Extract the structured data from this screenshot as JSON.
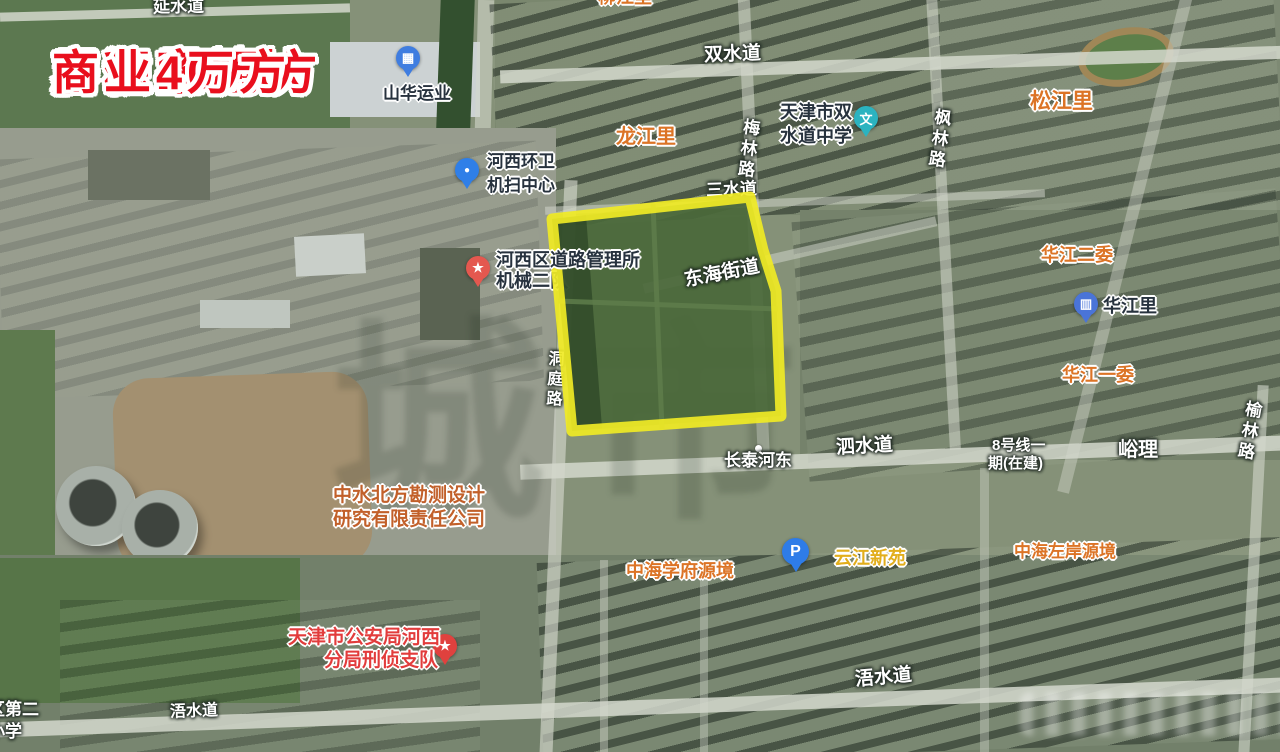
{
  "annotation": {
    "lines": [
      "富江里地块",
      "容积率2.0",
      "居住10万方",
      "商业4万方"
    ],
    "color": "#e90f1d"
  },
  "parcel": {
    "outline_color": "#f0ea25",
    "fill_color": "#4a683a"
  },
  "watermark": {
    "text": "城市"
  },
  "pois": {
    "shanhua": {
      "label": "山华运业",
      "glyph": "▦",
      "pin_color": "#3f7de0"
    },
    "huanwei": {
      "line1": "河西环卫",
      "line2": "机扫中心",
      "glyph": "●",
      "pin_color": "#2f7fe8"
    },
    "daolu": {
      "line1": "河西区道路管理所",
      "line2": "机械二队",
      "glyph": "★",
      "pin_color": "#e4584f"
    },
    "zhongxue": {
      "line1": "天津市双",
      "line2": "水道中学",
      "glyph": "文",
      "pin_color": "#2bb3c0"
    },
    "huajiangli": {
      "label": "华江里",
      "glyph": "▥",
      "pin_color": "#4a74d8"
    },
    "parking": {
      "glyph": "P",
      "pin_color": "#2e7ce8"
    },
    "gonganju": {
      "line1": "天津市公安局河西",
      "line2": "分局刑侦支队",
      "glyph": "★",
      "pin_color": "#e0413e"
    },
    "zhongshui": {
      "line1": "中水北方勘测设计",
      "line2": "研究有限责任公司"
    }
  },
  "areas": {
    "longjiangli": "龙江里",
    "songjiangli": "松江里",
    "huajiang_erwei": "华江二委",
    "huajiang_yiwei": "华江一委",
    "zhonghai_xuefu": "中海学府源境",
    "yunjiang_xinyuan": "云江新苑",
    "zhonghai_zuoan": "中海左岸源境",
    "changtai_hedong": "长泰河东",
    "yuli": "峪理",
    "line8_l1": "8号线一",
    "line8_l2": "期(在建)",
    "clipped_top": "柳江里"
  },
  "roads": {
    "yanshuidao": "延水道",
    "shuangshuidao": "双水道",
    "meilinlu": "梅林路",
    "fenglinlu": "枫林路",
    "sanshuidao": "三水道",
    "donghaijiedao": "东海街道",
    "dongtinglu": "洞庭路",
    "sishuidao": "泗水道",
    "yulinlu": "榆林路",
    "wushuidao_east": "浯水道",
    "wushuidao_west": "浯水道",
    "school_l1": "区第二",
    "school_l2": "小学"
  }
}
